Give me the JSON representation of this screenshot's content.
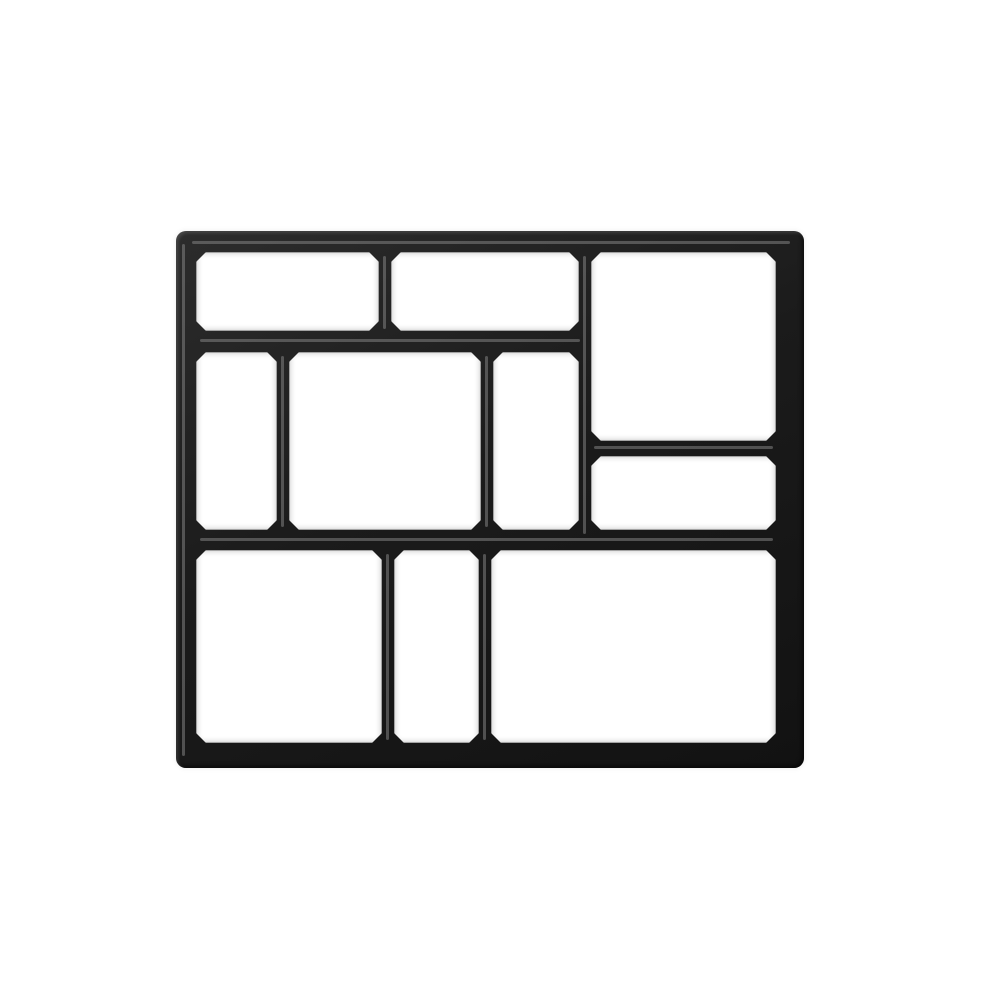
{
  "meta": {
    "type": "product-photo",
    "subject": "Black plastic 10-cavity DIY paving / path maker mold, top view on plain white background",
    "background_color": "#ffffff"
  },
  "mold": {
    "color_dark": "#1b1b1b",
    "highlight_color": "#8a8a8a",
    "frame": {
      "x": 176,
      "y": 231,
      "width": 628,
      "height": 537,
      "corner_radius": 10
    },
    "cells": [
      {
        "id": "top-left",
        "x": 196,
        "y": 252,
        "w": 183,
        "h": 79
      },
      {
        "id": "top-middle",
        "x": 391,
        "y": 252,
        "w": 188,
        "h": 79
      },
      {
        "id": "top-right-tall",
        "x": 591,
        "y": 252,
        "w": 185,
        "h": 189
      },
      {
        "id": "middle-left",
        "x": 196,
        "y": 352,
        "w": 81,
        "h": 178
      },
      {
        "id": "middle-center",
        "x": 289,
        "y": 352,
        "w": 192,
        "h": 178
      },
      {
        "id": "middle-right",
        "x": 493,
        "y": 352,
        "w": 86,
        "h": 178
      },
      {
        "id": "right-shelf",
        "x": 591,
        "y": 456,
        "w": 185,
        "h": 74
      },
      {
        "id": "bottom-left",
        "x": 196,
        "y": 550,
        "w": 186,
        "h": 193
      },
      {
        "id": "bottom-middle",
        "x": 394,
        "y": 550,
        "w": 85,
        "h": 193
      },
      {
        "id": "bottom-right",
        "x": 491,
        "y": 550,
        "w": 285,
        "h": 193
      }
    ],
    "wall_highlights": [
      {
        "id": "top-frame-ridge",
        "x": 192,
        "y": 241,
        "w": 598,
        "h": 3
      },
      {
        "id": "left-frame-ridge",
        "x": 182,
        "y": 244,
        "w": 3,
        "h": 512
      },
      {
        "id": "divider-top-1",
        "x": 383,
        "y": 256,
        "w": 3,
        "h": 73
      },
      {
        "id": "divider-top-right",
        "x": 583,
        "y": 256,
        "w": 3,
        "h": 278
      },
      {
        "id": "divider-mid-1",
        "x": 281,
        "y": 356,
        "w": 3,
        "h": 171
      },
      {
        "id": "divider-mid-2",
        "x": 485,
        "y": 356,
        "w": 3,
        "h": 171
      },
      {
        "id": "divider-bot-1",
        "x": 386,
        "y": 554,
        "w": 3,
        "h": 186
      },
      {
        "id": "divider-bot-2",
        "x": 483,
        "y": 554,
        "w": 3,
        "h": 186
      },
      {
        "id": "row-divider-upper",
        "x": 200,
        "y": 339,
        "w": 380,
        "h": 3
      },
      {
        "id": "shelf-divider-right",
        "x": 594,
        "y": 446,
        "w": 179,
        "h": 3
      },
      {
        "id": "row-divider-lower",
        "x": 200,
        "y": 538,
        "w": 573,
        "h": 3
      }
    ]
  }
}
